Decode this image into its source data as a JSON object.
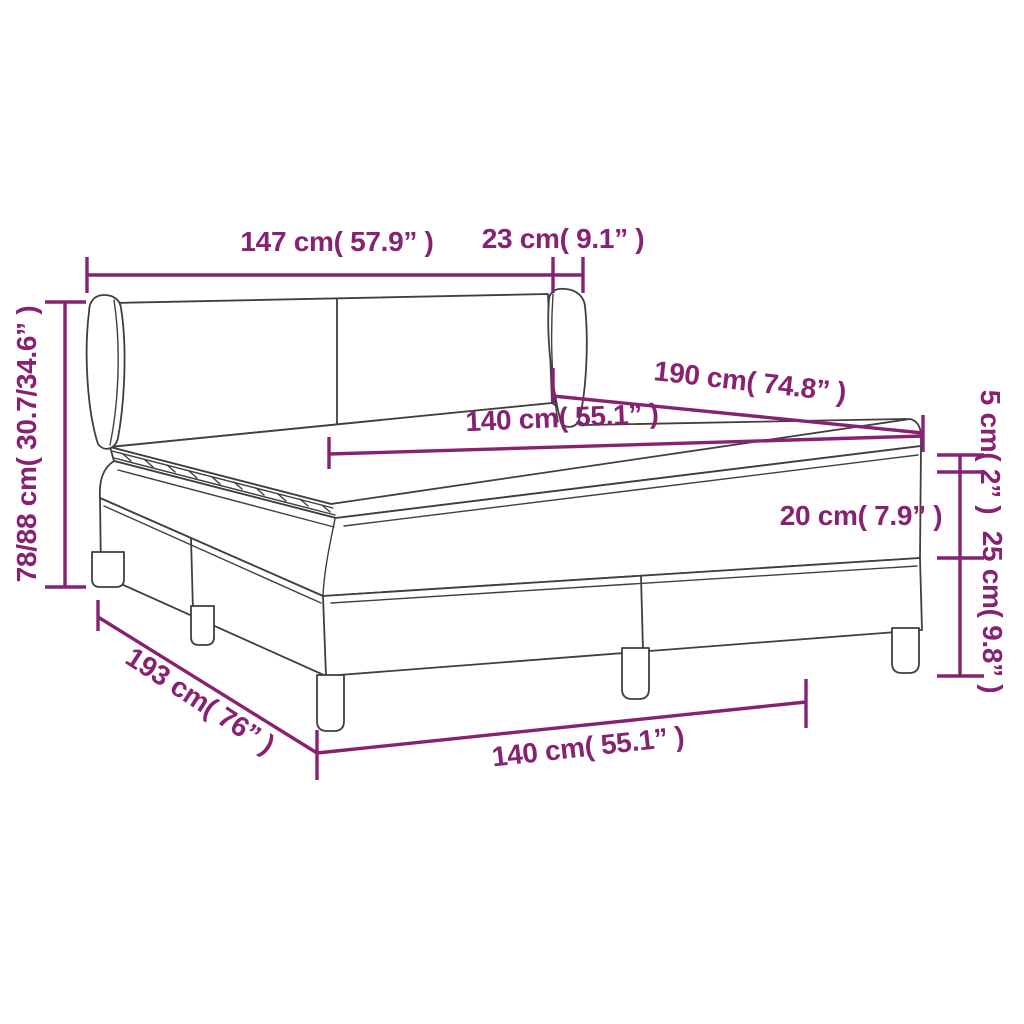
{
  "diagram": {
    "subject": "box-spring-bed-dimension-diagram",
    "background": "#FFFFFF",
    "colors": {
      "dimension_accent": "#872272",
      "line_art": "#3F3F3F"
    },
    "labels": {
      "headboard_width": "147 cm( 57.9” )",
      "wing_depth": "23 cm( 9.1” )",
      "bed_height": "78/88 cm( 30.7/34.6” )",
      "bed_length_top": "190 cm( 74.8” )",
      "mattress_width": "140 cm( 55.1” )",
      "mattress_height": "20 cm( 7.9” )",
      "topper_height": "5 cm( 2” )",
      "base_height": "25 cm( 9.8” )",
      "bed_length_bottom": "193 cm( 76” )",
      "bed_width_bottom": "140 cm( 55.1” )"
    }
  }
}
